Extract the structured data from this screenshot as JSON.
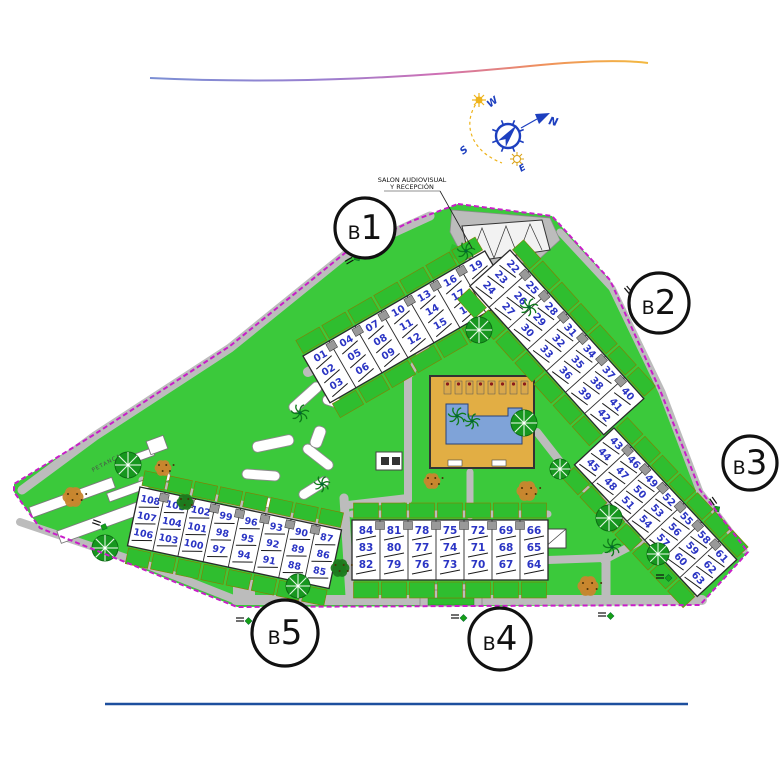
{
  "decorations": {
    "top_gradient_colors": [
      "#7b8fd4",
      "#9a7fd0",
      "#cf6fb4",
      "#ef8f5e",
      "#f3b93f"
    ],
    "bottom_line_color": "#1d4f9e"
  },
  "compass": {
    "north": "N",
    "south": "S",
    "east": "E",
    "west": "W"
  },
  "annotations": {
    "reception_line1": "SALON AUDIOVISUAL",
    "reception_line2": "Y RECEPCIÓN",
    "petanca": "PETANCA"
  },
  "blocks": [
    {
      "id": "b1",
      "label": "B1",
      "units": [
        [
          "01",
          "02",
          "03"
        ],
        [
          "04",
          "05",
          "06"
        ],
        [
          "07",
          "08",
          "09"
        ],
        [
          "10",
          "11",
          "12"
        ],
        [
          "13",
          "14",
          "15"
        ],
        [
          "16",
          "17",
          "18"
        ],
        [
          "19",
          "20",
          "21"
        ]
      ]
    },
    {
      "id": "b2",
      "label": "B2",
      "units": [
        [
          "22",
          "23",
          "24"
        ],
        [
          "25",
          "26",
          "27"
        ],
        [
          "28",
          "29",
          "30"
        ],
        [
          "31",
          "32",
          "33"
        ],
        [
          "34",
          "35",
          "36"
        ],
        [
          "37",
          "38",
          "39"
        ],
        [
          "40",
          "41",
          "42"
        ]
      ]
    },
    {
      "id": "b3",
      "label": "B3",
      "units": [
        [
          "43",
          "44",
          "45"
        ],
        [
          "46",
          "47",
          "48"
        ],
        [
          "49",
          "50",
          "51"
        ],
        [
          "52",
          "53",
          "54"
        ],
        [
          "55",
          "56",
          "57"
        ],
        [
          "58",
          "59",
          "60"
        ],
        [
          "61",
          "62",
          "63"
        ]
      ]
    },
    {
      "id": "b4",
      "label": "B4",
      "units": [
        [
          "84",
          "83",
          "82"
        ],
        [
          "81",
          "80",
          "79"
        ],
        [
          "78",
          "77",
          "76"
        ],
        [
          "75",
          "74",
          "73"
        ],
        [
          "72",
          "71",
          "70"
        ],
        [
          "69",
          "68",
          "67"
        ],
        [
          "66",
          "65",
          "64"
        ]
      ]
    },
    {
      "id": "b5",
      "label": "B5",
      "units": [
        [
          "108",
          "107",
          "106"
        ],
        [
          "105",
          "104",
          "103"
        ],
        [
          "102",
          "101",
          "100"
        ],
        [
          "99",
          "98",
          "97"
        ],
        [
          "96",
          "95",
          "94"
        ],
        [
          "93",
          "92",
          "91"
        ],
        [
          "90",
          "89",
          "88"
        ],
        [
          "87",
          "86",
          "85"
        ]
      ]
    }
  ],
  "colors": {
    "lawn": "#3bc93b",
    "terrace": "#2fbe2f",
    "road": "#bcbcbc",
    "boundary": "#c81ec8",
    "block_fill": "#ffffff",
    "block_edge": "#2a2a2a",
    "unit_number": "#2b35c4",
    "pool_deck": "#e2ae44",
    "pool_water": "#7fa3d8",
    "tree": "#17971f",
    "palm": "#0e7a1a",
    "bush": "#c8862e",
    "label_ring": "#111111",
    "compass_blue": "#1d3fbf",
    "sun_yellow": "#eeb31b"
  }
}
